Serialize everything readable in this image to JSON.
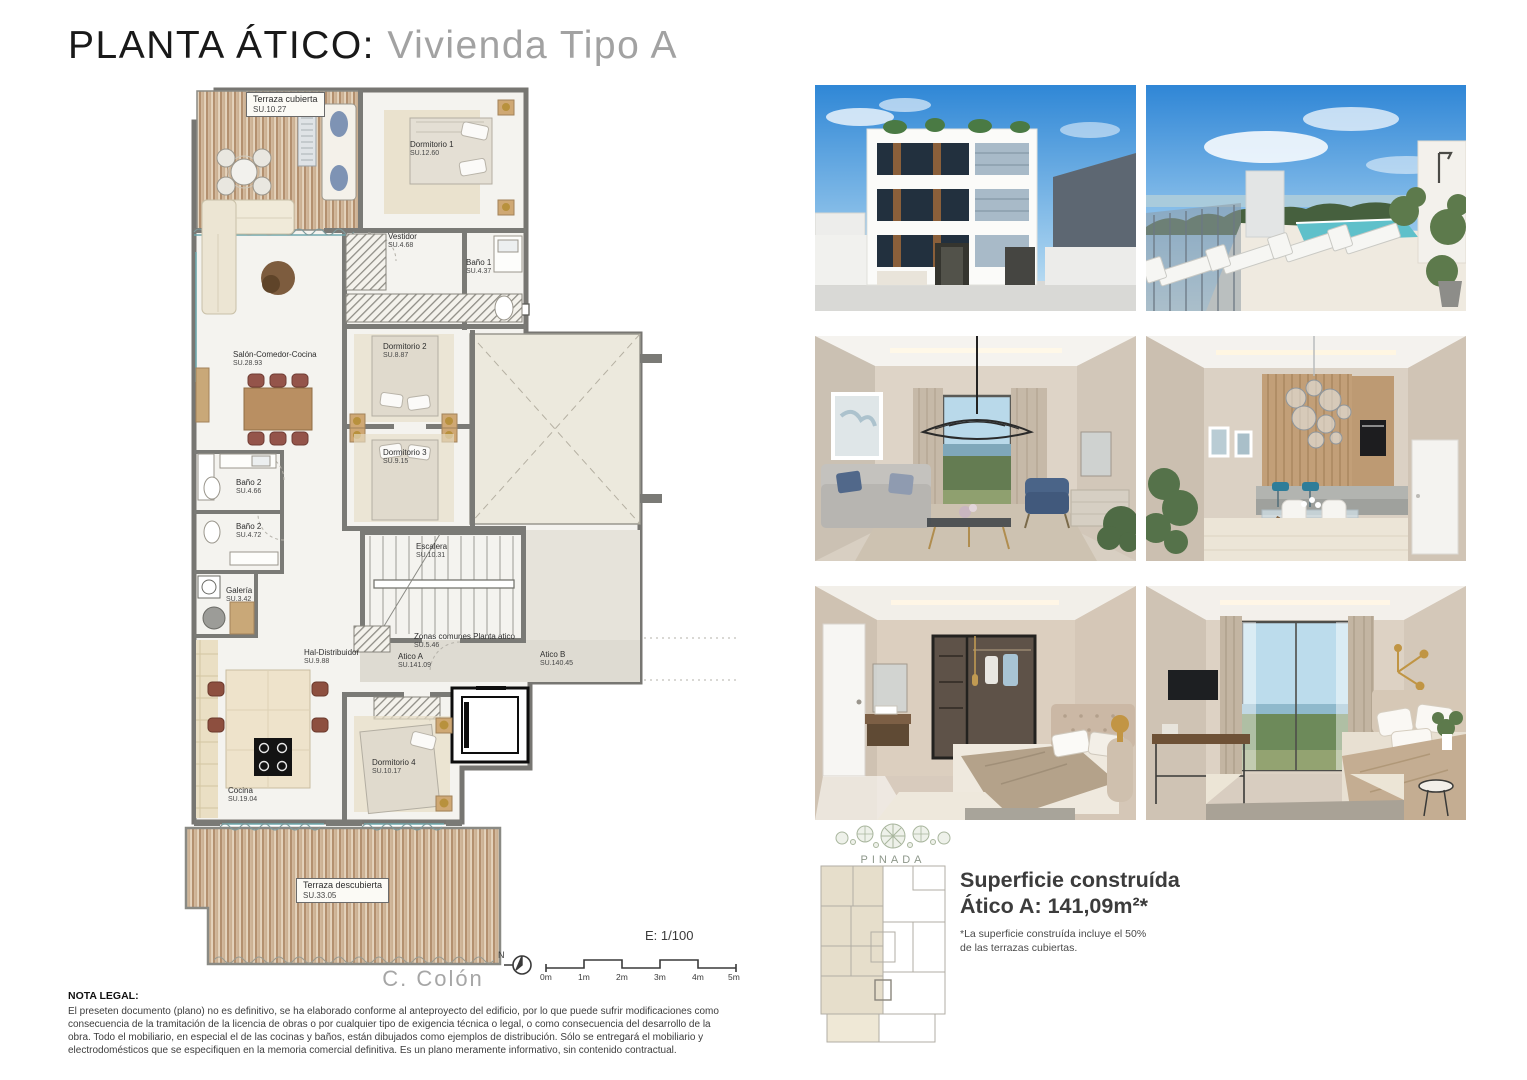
{
  "page": {
    "title_black": "PLANTA ÁTICO:",
    "title_gray": " Vivienda Tipo A"
  },
  "plan": {
    "street_label": "C. Colón",
    "scale_label": "E: 1/100",
    "north_label": "N",
    "scale_ticks": [
      "0m",
      "1m",
      "2m",
      "3m",
      "4m",
      "5m"
    ],
    "rooms": [
      {
        "name": "Terraza cubierta",
        "area": "SU.10.27"
      },
      {
        "name": "Dormitorio 1",
        "area": "SU.12.60"
      },
      {
        "name": "Vestidor",
        "area": "SU.4.68"
      },
      {
        "name": "Baño 1",
        "area": "SU.4.37"
      },
      {
        "name": "Salón-Comedor-Cocina",
        "area": "SU.28.93"
      },
      {
        "name": "Dormitorio 2",
        "area": "SU.8.87"
      },
      {
        "name": "Dormitorio 3",
        "area": "SU.9.15"
      },
      {
        "name": "Baño 2",
        "area": "SU.4.66"
      },
      {
        "name": "Baño 2",
        "area": "SU.4.72"
      },
      {
        "name": "Galería",
        "area": "SU.3.42"
      },
      {
        "name": "Escalera",
        "area": "SU.10.31"
      },
      {
        "name": "Hal-Distribuidor",
        "area": "SU.9.88"
      },
      {
        "name": "Zonas comunes Planta atico",
        "area": "SU.5.46"
      },
      {
        "name": "Atico A",
        "area": "SU.141.09"
      },
      {
        "name": "Atico B",
        "area": "SU.140.45"
      },
      {
        "name": "Dormitorio 4",
        "area": "SU.10.17"
      },
      {
        "name": "Cocina",
        "area": "SU.19.04"
      },
      {
        "name": "Terraza descubierta",
        "area": "SU.33.05"
      }
    ]
  },
  "legal": {
    "heading": "NOTA LEGAL:",
    "body": "El preseten documento (plano) no es definitivo, se ha elaborado conforme al anteproyecto del edificio, por lo que puede sufrir modificaciones como consecuencia de la tramitación de la licencia de obras o por cualquier tipo de exigencia técnica o legal, o como consecuencia del desarrollo de la obra. Todo el mobiliario, en especial el de las cocinas y baños, están dibujados como ejemplos de distribución. Sólo se entregará el mobiliario y electrodomésticos que se especifiquen en la memoria comercial definitiva. Es un plano meramente informativo, sin contenido contractual."
  },
  "summary": {
    "brand": "PINADA",
    "title_line1": "Superficie construída",
    "title_line2": "Ático A: 141,09m²*",
    "footnote": "*La superficie construída incluye el 50% de las terrazas cubiertas."
  },
  "photos": {
    "items": [
      {
        "name": "building-facade-render"
      },
      {
        "name": "rooftop-pool-terrace-render"
      },
      {
        "name": "living-room-render"
      },
      {
        "name": "dining-kitchen-render"
      },
      {
        "name": "bedroom-walkin-closet-render"
      },
      {
        "name": "bedroom-sea-view-render"
      }
    ]
  },
  "colors": {
    "accent_wood": "#c2a27d",
    "wall_gray": "#7a7a76",
    "sky_blue": "#3a8fd9",
    "pool_teal": "#6ec6cf",
    "brand_green": "#a9b69e"
  }
}
